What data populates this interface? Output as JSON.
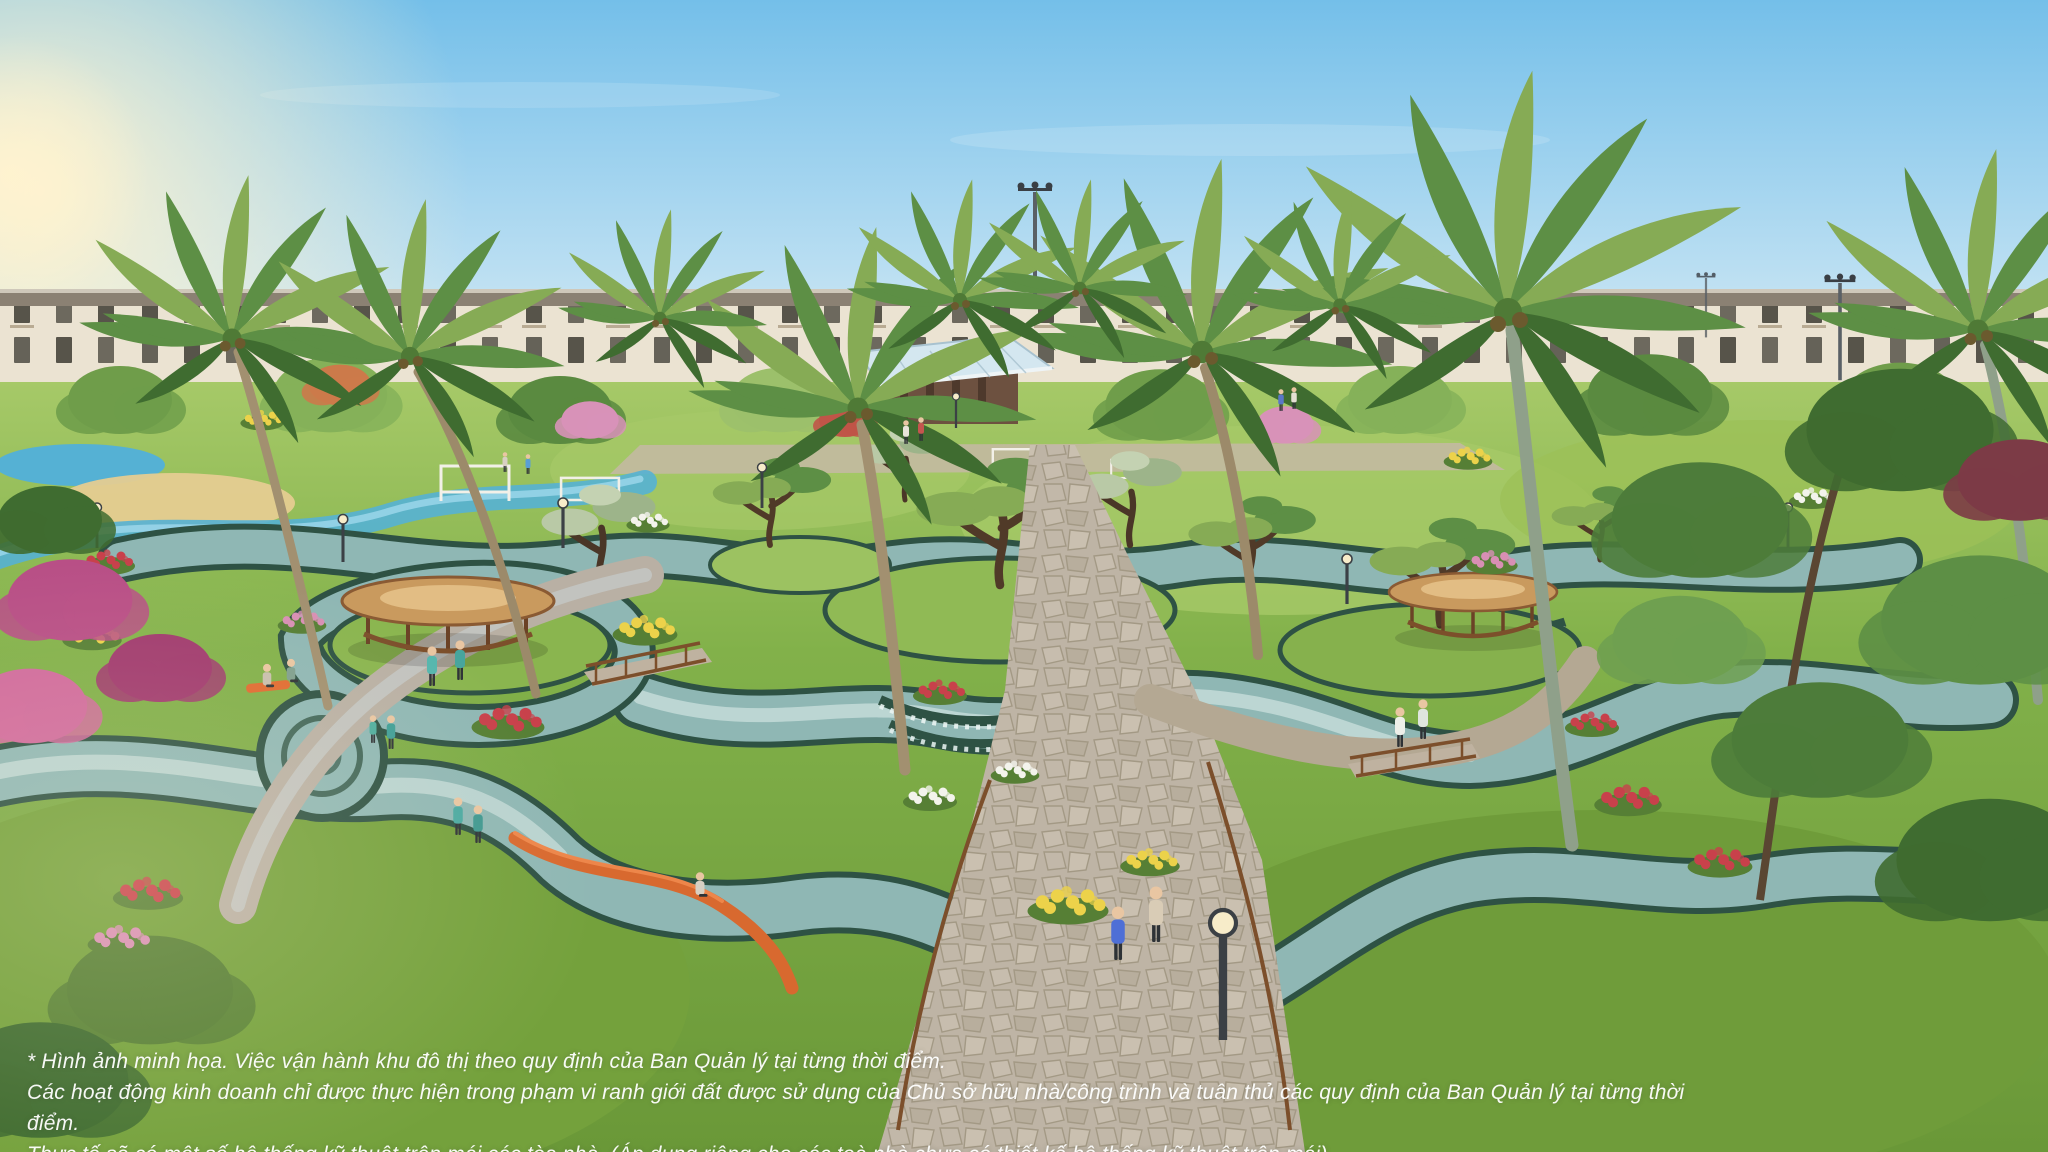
{
  "scene": {
    "description": "Aerial marketing rendering of a tropical landscaped urban park: winding teal lazy-river channels with terraced weirs, bonsai islands, flower beds, round wooden gazebos, flagstone walkways with strolling residents, tall coconut palms, and a continuous row of cream low-rise shophouses on the horizon under a clear blue sky with sun flare at the left.",
    "palette": {
      "sky_top": "#74bfe9",
      "sky_mid": "#b9def2",
      "sky_horizon": "#e9f4f3",
      "sun_glow": "#fff3cf",
      "building_facade": "#ebe3d2",
      "building_roof": "#8b8173",
      "building_window": "#57544a",
      "canopy_glass": "#d4e7f0",
      "lawn": "#82b14a",
      "lawn_dark": "#6a9838",
      "lawn_light": "#a6c968",
      "river_wall": "#2e5244",
      "river_water": "#8fb7b4",
      "river_light": "#cfe2df",
      "stream_blue": "#55b1d4",
      "sand": "#e5cc91",
      "path_stone": "#b7a996",
      "path_joint": "#97886f",
      "wood_dark": "#7c4f2b",
      "gazebo_roof": "#c99a5e",
      "palm_trunk": "#a29070",
      "foliage_dark": "#3f6c30",
      "foliage": "#5d8f45",
      "foliage_light": "#86ab55",
      "flower_red": "#c8414b",
      "flower_pink": "#d88fb4",
      "flower_yellow": "#ecd24a",
      "flower_white": "#f3f3ec",
      "flower_magenta": "#b84f86",
      "bench_orange": "#d8692f",
      "lamp_metal": "#3b4045",
      "skin": "#e9c6a2",
      "text_white": "#ffffff"
    }
  },
  "disclaimer": {
    "lines": [
      "* Hình ảnh minh họa. Việc vận hành khu đô thị theo quy định của Ban Quản lý tại từng thời điểm.",
      "Các hoạt động kinh doanh chỉ được thực hiện trong phạm vi ranh giới đất được sử dụng của Chủ sở hữu nhà/công trình và tuân thủ các quy định của Ban Quản lý tại từng thời điểm.",
      "Thực tế sẽ có một số hệ thống kỹ thuật trên mái các tòa nhà. (Áp dụng riêng cho các toà nhà chưa có thiết kế hệ thống kỹ thuật trên mái)"
    ]
  }
}
